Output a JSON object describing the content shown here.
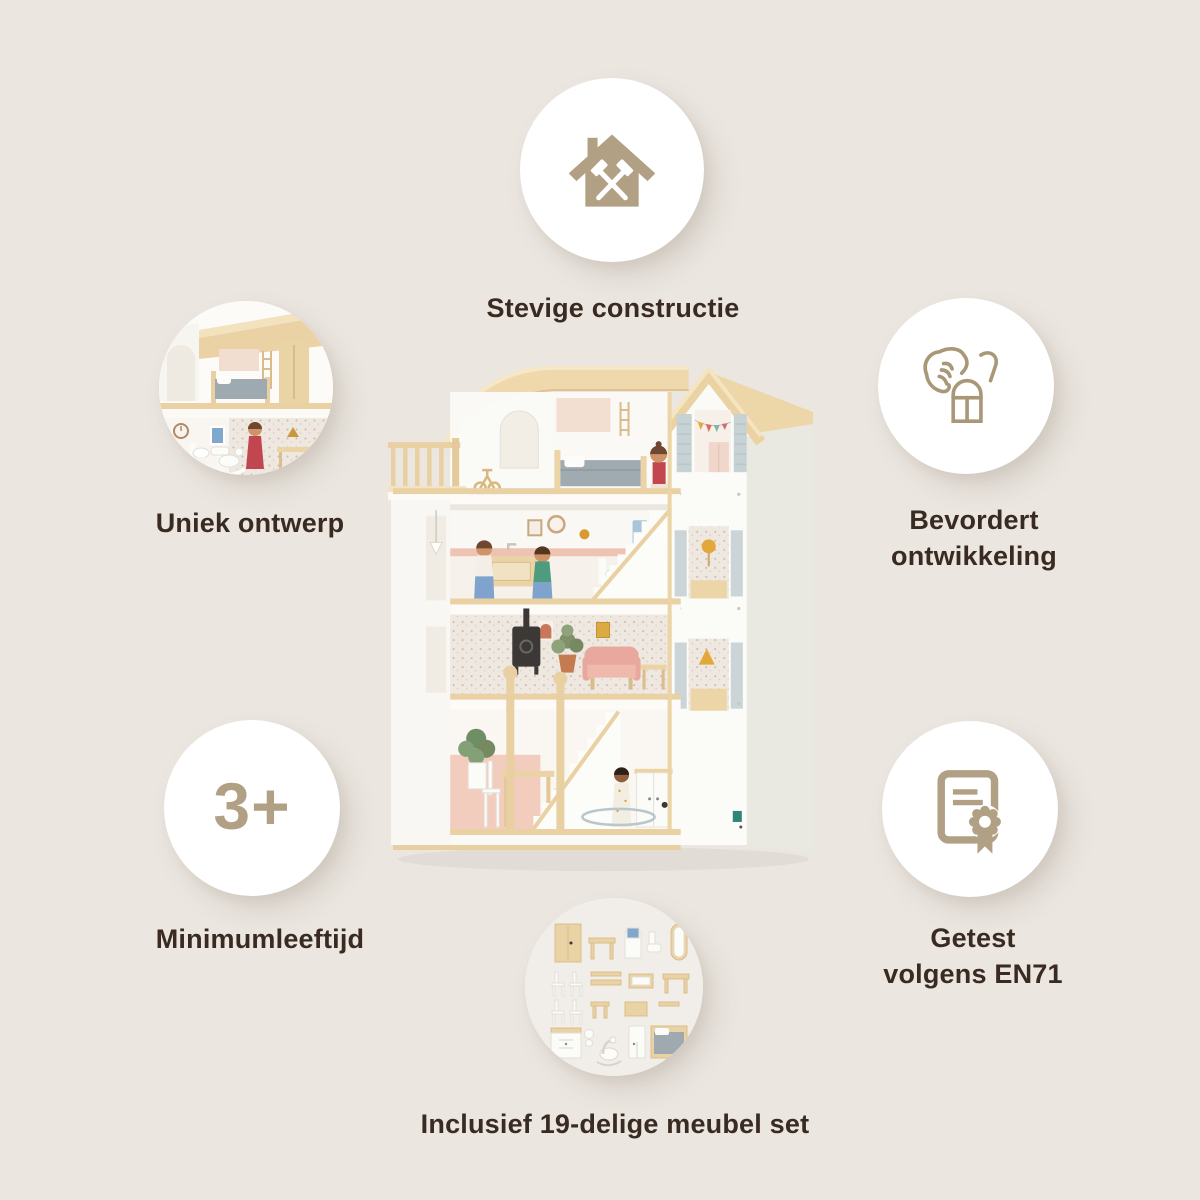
{
  "title": "Dollhouse feature infographic",
  "colors": {
    "background": "#EBE6E0",
    "accent": "#B1A084",
    "text": "#392B21",
    "circle_fill": "#FFFFFF"
  },
  "features": {
    "construction": {
      "label": "Stevige constructie",
      "icon": "house-with-hammers"
    },
    "design": {
      "label": "Uniek ontwerp",
      "media": "dollhouse-interior-photo"
    },
    "development": {
      "line1": "Bevordert",
      "line2": "ontwikkeling",
      "icon": "hand-placing-block"
    },
    "age": {
      "label": "Minimumleeftijd",
      "badge": "3+"
    },
    "tested": {
      "line1": "Getest",
      "line2": "volgens EN71",
      "icon": "certificate-with-rosette"
    },
    "furniture": {
      "label": "Inclusief 19-delige meubel set",
      "media": "furniture-set-photo"
    }
  },
  "product": {
    "media": "wooden-dollhouse-photo"
  }
}
